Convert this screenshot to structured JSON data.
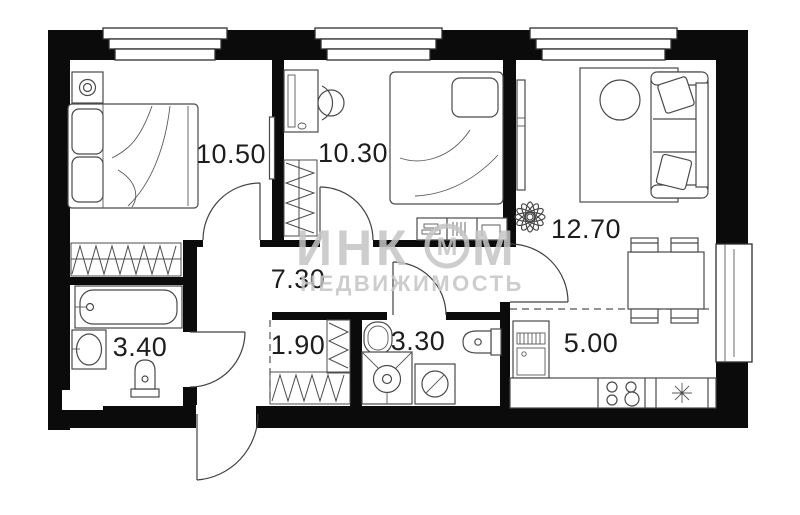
{
  "rooms": {
    "bedroom1": {
      "label": "10.50"
    },
    "bedroom2": {
      "label": "10.30"
    },
    "hallway": {
      "label": "7.30"
    },
    "bathroom": {
      "label": "3.40"
    },
    "closet": {
      "label": "1.90"
    },
    "wc": {
      "label": "3.30"
    },
    "living_room": {
      "label": "12.70"
    },
    "kitchen": {
      "label": "5.00"
    }
  },
  "watermark": {
    "text_main_prefix": "ИНК",
    "logo_circle_letter": "М",
    "text_main_suffix": "М",
    "text_secondary": "НЕДВИЖИМОСТЬ"
  },
  "colors": {
    "walls": "#0b0b0b",
    "furniture_lines": "#4a4a4a",
    "watermark": "#c4c4c4",
    "background": "#ffffff"
  }
}
